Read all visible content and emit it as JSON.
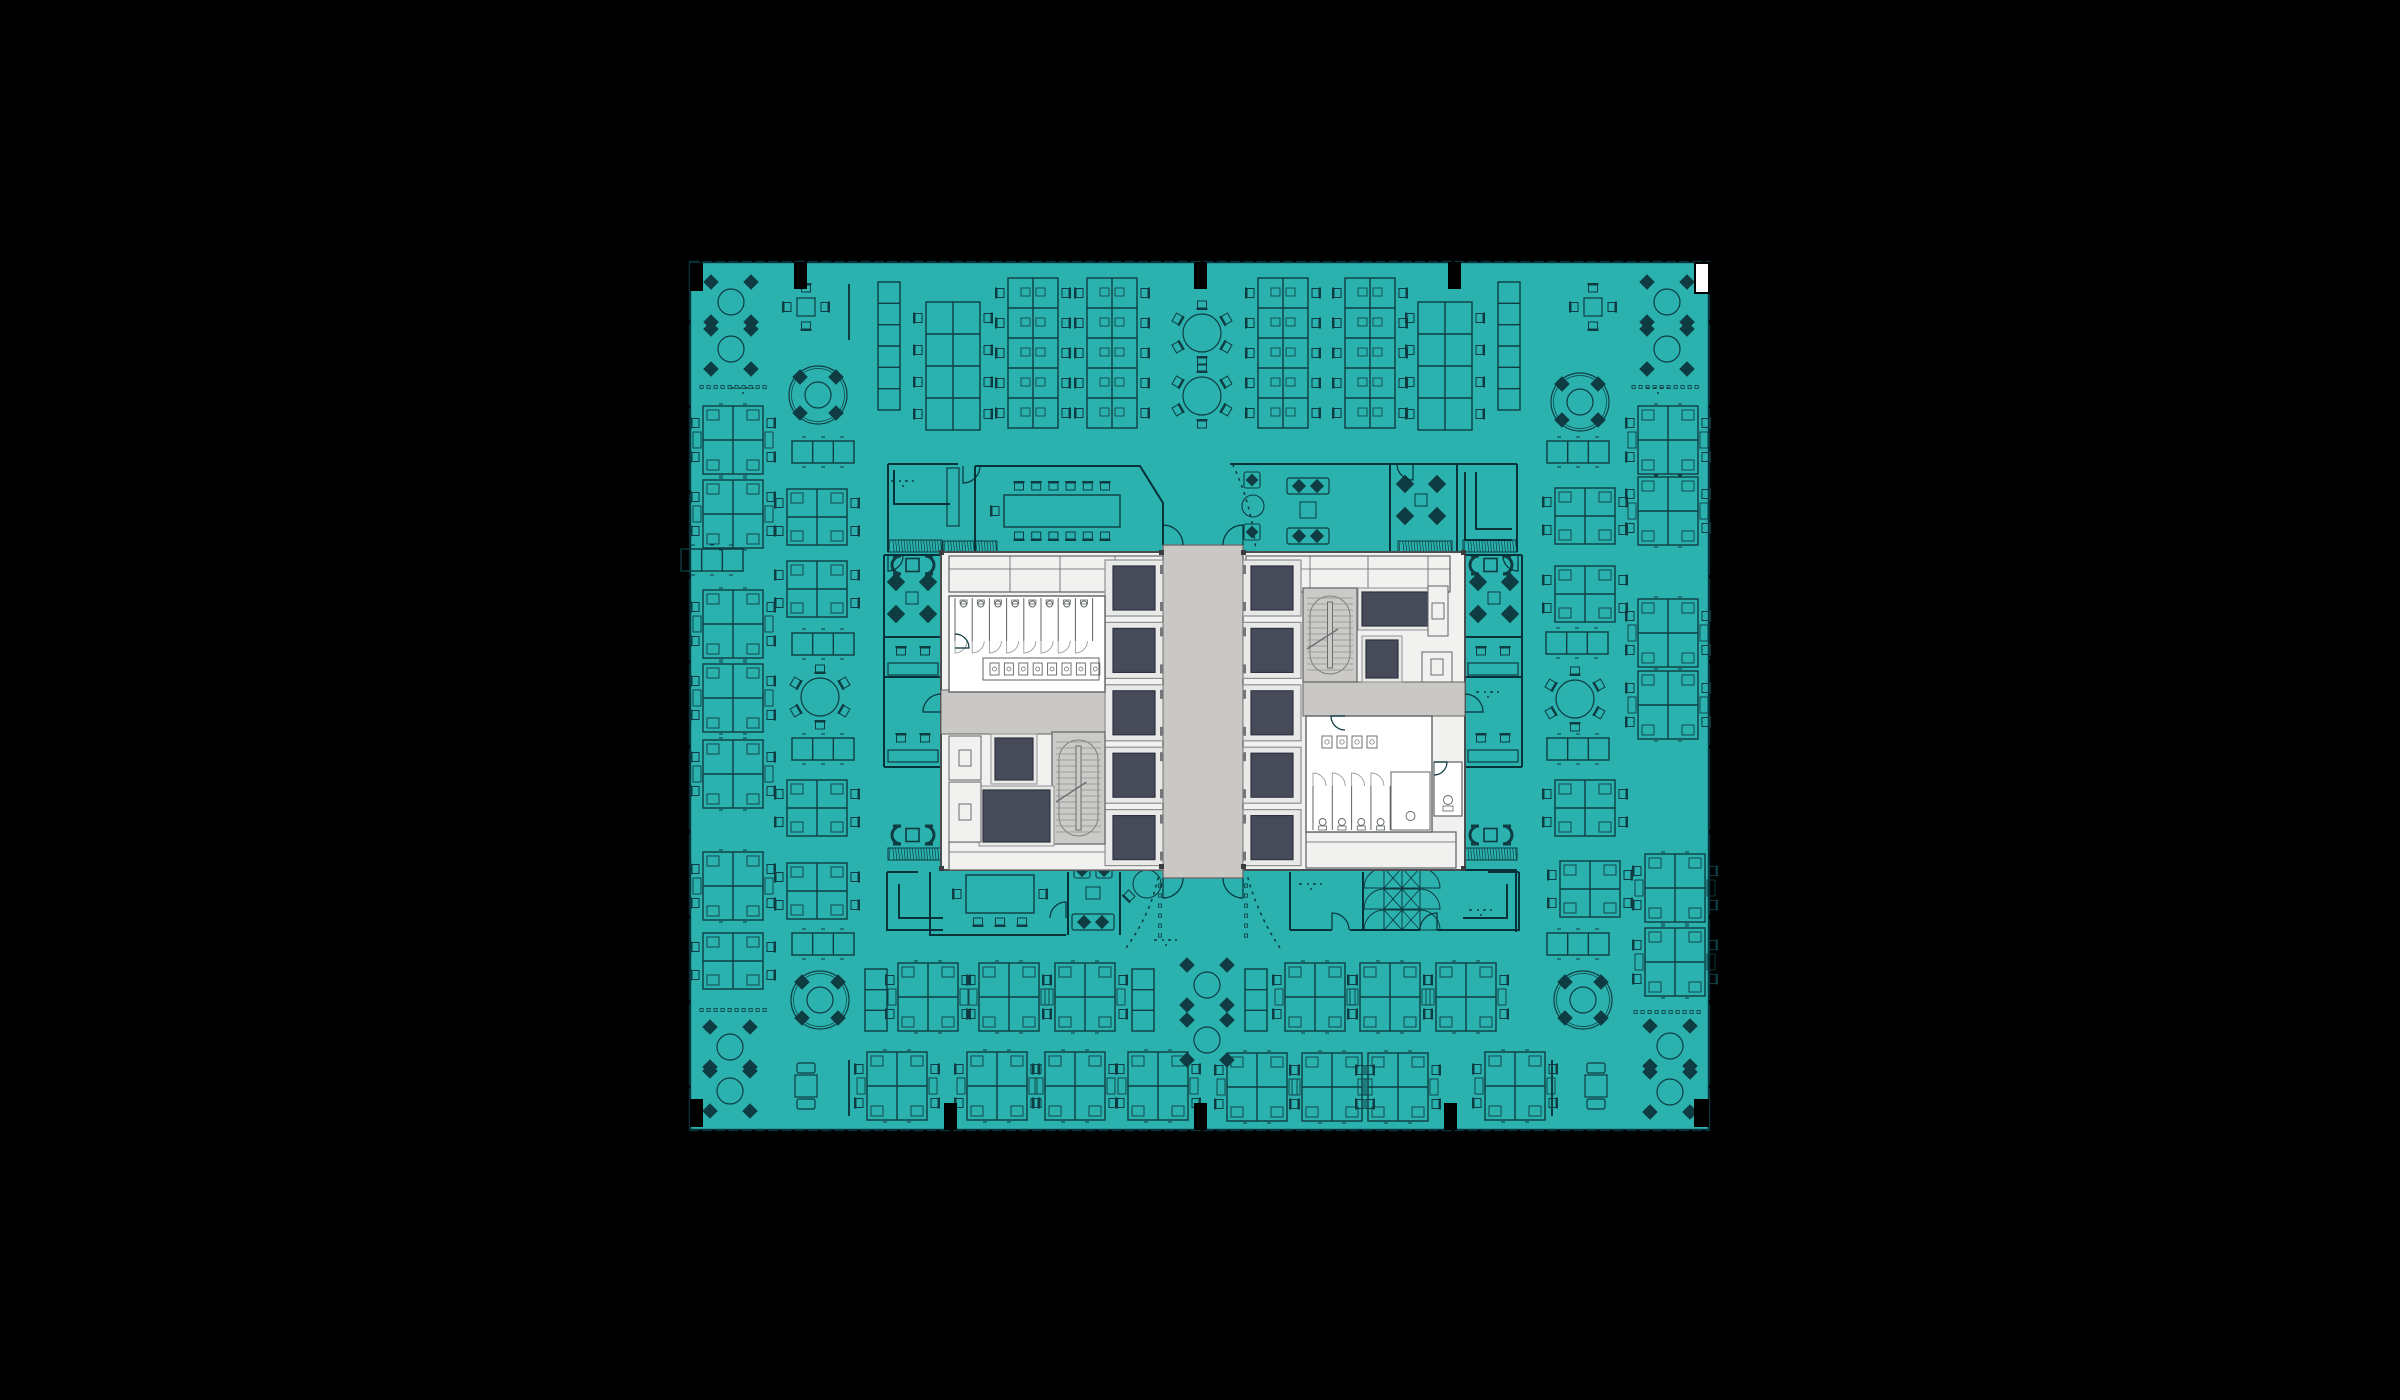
{
  "scene": {
    "width": 2400,
    "height": 1400,
    "background": "#000000",
    "description": "office-floor-plan"
  },
  "palette": {
    "teal": "#2BB2AE",
    "furnitureLine": "#0E3C42",
    "wallLine": "#06333A",
    "coreWhite": "#F1F1EF",
    "coreFill": "#EDEDEB",
    "coreWall": "#5E6264",
    "lobbyGray": "#C9C8C4",
    "stairGray": "#CBCAC7",
    "navy": "#464A59",
    "navyStroke": "#2E3240",
    "frame": "#E9E9E7",
    "frameStroke": "#8E9192",
    "black": "#000000",
    "white": "#FFFFFF",
    "darkSquare": "#3A3D3F",
    "notch": "#747678"
  },
  "plan": {
    "x": 690,
    "y": 262,
    "w": 1019,
    "h": 868,
    "tickStepTop": 13.2,
    "tickStepSide": 85
  },
  "columns": {
    "cornersBlack": [
      [
        690,
        263,
        13,
        28
      ],
      [
        690,
        1099,
        13,
        28
      ],
      [
        1694,
        1099,
        15,
        28
      ]
    ],
    "cornerWhite": [
      1695,
      263,
      14,
      30
    ],
    "topStubs": [
      794,
      1194,
      1448
    ],
    "bottomStubs": [
      944,
      1194,
      1444
    ],
    "stubSize": [
      13,
      27
    ]
  },
  "core": {
    "outer": [
      941,
      552,
      524,
      318
    ],
    "lobby": [
      1163,
      545,
      80,
      333
    ],
    "elevatorCols": [
      {
        "x": 1105,
        "w": 58,
        "y0": 560,
        "cellH": 56,
        "gap": 6.4,
        "count": 5,
        "doorSide": "right"
      },
      {
        "x": 1243,
        "w": 58,
        "y0": 560,
        "cellH": 56,
        "gap": 6.4,
        "count": 5,
        "doorSide": "left"
      }
    ],
    "topBands": [
      [
        949,
        556,
        214,
        36
      ],
      [
        1246,
        556,
        204,
        36
      ]
    ],
    "topBandDividersL": [
      1010,
      1060,
      1115
    ],
    "topBandDividersR": [
      1310,
      1368,
      1428
    ],
    "bottomBands": [
      [
        949,
        842,
        214,
        28
      ],
      [
        1306,
        832,
        150,
        36
      ]
    ],
    "vestibules": [
      [
        941,
        690,
        164,
        44
      ],
      [
        1303,
        682,
        162,
        34
      ]
    ],
    "stairs": [
      [
        1052,
        732,
        53,
        112
      ],
      [
        1303,
        588,
        54,
        94
      ]
    ],
    "navyRooms": [
      [
        995,
        738,
        38,
        42
      ],
      [
        983,
        790,
        67,
        52
      ],
      [
        1362,
        592,
        66,
        34
      ],
      [
        1366,
        640,
        32,
        38
      ]
    ],
    "closets": [
      [
        949,
        736,
        32,
        44
      ],
      [
        949,
        782,
        32,
        60
      ],
      [
        1428,
        586,
        20,
        50
      ],
      [
        1422,
        652,
        30,
        30
      ]
    ],
    "mensRR": {
      "room": [
        949,
        596,
        156,
        96
      ],
      "stalls": 8,
      "stallX0": 955,
      "stallStep": 17.2,
      "stallTop": 598,
      "stallBot": 641,
      "urinalY": 603,
      "sinkBand": [
        983,
        658,
        116,
        22
      ],
      "sinks": 8
    },
    "womensRR": {
      "room": [
        1306,
        716,
        126,
        116
      ],
      "sinks": 4,
      "sinkX0": 1322,
      "sinkStep": 15,
      "sinkY": 736,
      "stalls": 4,
      "stallX0": 1313,
      "stallStep": 19.3,
      "stallTop": 786,
      "stallBot": 830,
      "accessible": [
        1391,
        772,
        39,
        58
      ]
    },
    "wc": [
      1434,
      762,
      28,
      54
    ],
    "darkSquares": [
      [
        939,
        550
      ],
      [
        1461,
        550
      ],
      [
        939,
        866
      ],
      [
        1461,
        866
      ],
      [
        1159,
        550
      ],
      [
        1241,
        550
      ],
      [
        1159,
        864
      ],
      [
        1241,
        864
      ]
    ]
  },
  "walls": [
    "M888,464 H958",
    "M888,464 V552",
    "M894,470 V504 H950",
    "M975,466 V552",
    "M975,466 H1140 L1163,503 V545",
    "M1230,464 H1517",
    "M1517,464 V552",
    "M1390,464 V552",
    "M1457,464 V552",
    "M1465,472 V540 H1512",
    "M1476,472 V529 H1512",
    "M884,555 V767",
    "M884,555 H941",
    "M884,637 H941",
    "M884,677 H941",
    "M884,767 H941",
    "M887,872 V930 H943",
    "M887,872 H918",
    "M899,884 V918 H943",
    "M1522,555 V767",
    "M1465,555 H1522",
    "M1465,637 H1522",
    "M1465,677 H1522",
    "M1465,767 H1522",
    "M1519,872 V930 H1463",
    "M1519,872 H1488",
    "M1507,884 V918 H1463",
    "M930,872 V935 H1066",
    "M1068,872 V935",
    "M1120,872 V935",
    "M1290,872 V930",
    "M1290,930 H1332",
    "M1350,930 H1420",
    "M1437,930 H1465",
    "M1363,872 V930",
    "M1440,870 H1516 V932",
    "M1465,858 V870"
  ],
  "doorArcs": [
    "M963,466 L963,483 A17,17 0 0 0 980,466",
    "M1413,464 L1413,480 A16,16 0 0 1 1397,464",
    "M1066,918 L1066,902 A16,16 0 0 0 1050,918",
    "M1332,930 L1332,913 A17,17 0 0 1 1349,930",
    "M1437,930 L1437,913 A17,17 0 0 0 1420,930",
    "M888,556 L888,571 A15,15 0 0 0 903,556",
    "M1518,556 L1518,571 A15,15 0 0 1 1503,556",
    "M1163,545 V525 A20,20 0 0 1 1183,545",
    "M1243,545 V525 A20,20 0 0 0 1223,545",
    "M1163,878 V898 A20,20 0 0 0 1183,878",
    "M1243,878 V898 A20,20 0 0 1 1223,878",
    "M941,712 L923,712 A18,18 0 0 1 941,694",
    "M955,648 L969,648 A14,14 0 0 0 955,634",
    "M1465,712 L1483,712 A18,18 0 0 0 1465,694",
    "M1345,716 L1331,716 A14,14 0 0 0 1345,730",
    "M1434,762 L1447,762 A13,13 0 0 1 1434,775"
  ],
  "dottedPaths": [
    "M1233,465 Q1252,505 1256,552",
    "M1158,878 Q1150,915 1126,948",
    "M1248,878 Q1258,915 1280,948"
  ],
  "dotCols": [
    [
      1160,
      884,
      6
    ],
    [
      1246,
      884,
      6
    ]
  ],
  "furniture": [
    [
      "round4",
      731,
      302
    ],
    [
      "round4",
      731,
      349
    ],
    [
      "dotrow",
      733,
      387
    ],
    [
      "sq4",
      806,
      307
    ],
    [
      "vline",
      849,
      312
    ],
    [
      "lockers6v",
      889,
      346
    ],
    [
      "bench8",
      953,
      366
    ],
    [
      "bench10",
      1033,
      353
    ],
    [
      "bench10",
      1112,
      353
    ],
    [
      "round6",
      1202,
      333
    ],
    [
      "round6",
      1202,
      396
    ],
    [
      "bench10",
      1283,
      353
    ],
    [
      "bench10",
      1370,
      353
    ],
    [
      "bench8",
      1445,
      366
    ],
    [
      "lockers6v",
      1509,
      346
    ],
    [
      "sq4",
      1593,
      307
    ],
    [
      "round4",
      1667,
      302
    ],
    [
      "round4",
      1667,
      349
    ],
    [
      "dotrow",
      1665,
      387
    ],
    [
      "cluster6",
      733,
      440
    ],
    [
      "cluster6",
      733,
      514
    ],
    [
      "cluster6",
      733,
      624
    ],
    [
      "cluster6",
      733,
      698
    ],
    [
      "cluster6",
      733,
      774
    ],
    [
      "cluster6",
      733,
      886
    ],
    [
      "cluster4",
      733,
      961
    ],
    [
      "round4",
      730,
      1047
    ],
    [
      "round4",
      730,
      1091
    ],
    [
      "round4ring",
      818,
      395
    ],
    [
      "table3h",
      823,
      452
    ],
    [
      "cluster4",
      817,
      517
    ],
    [
      "cluster4",
      817,
      589
    ],
    [
      "table3h",
      823,
      644
    ],
    [
      "round6",
      820,
      697
    ],
    [
      "table3h",
      823,
      749
    ],
    [
      "cluster4",
      817,
      808
    ],
    [
      "cluster4",
      817,
      891
    ],
    [
      "table3h",
      823,
      944
    ],
    [
      "round4ring",
      820,
      1000
    ],
    [
      "sqtable2",
      806,
      1086
    ],
    [
      "vline",
      849,
      1088
    ],
    [
      "table3h",
      712,
      560
    ],
    [
      "lockers3v",
      876,
      1000
    ],
    [
      "cluster6",
      928,
      997
    ],
    [
      "cluster6",
      1009,
      997
    ],
    [
      "cluster6",
      1085,
      997
    ],
    [
      "lockers3v",
      1143,
      1000
    ],
    [
      "round4",
      1207,
      985
    ],
    [
      "round4",
      1207,
      1040
    ],
    [
      "lockers3v",
      1256,
      1000
    ],
    [
      "cluster6",
      1315,
      997
    ],
    [
      "cluster6",
      1390,
      997
    ],
    [
      "cluster6",
      1466,
      997
    ],
    [
      "cluster6",
      897,
      1086
    ],
    [
      "cluster6",
      997,
      1086
    ],
    [
      "cluster6",
      1075,
      1086
    ],
    [
      "cluster6",
      1158,
      1086
    ],
    [
      "cluster6",
      1257,
      1087
    ],
    [
      "cluster6",
      1332,
      1087
    ],
    [
      "cluster6",
      1398,
      1087
    ],
    [
      "cluster6",
      1515,
      1086
    ],
    [
      "sqtable2",
      1596,
      1086
    ],
    [
      "vline",
      1552,
      1088
    ],
    [
      "round4",
      1670,
      1046
    ],
    [
      "round4",
      1670,
      1092
    ],
    [
      "dotrow",
      733,
      1010
    ],
    [
      "dotrow",
      1667,
      1012
    ],
    [
      "round4ring",
      1580,
      402
    ],
    [
      "table3h",
      1578,
      452
    ],
    [
      "cluster4",
      1585,
      516
    ],
    [
      "cluster4",
      1585,
      594
    ],
    [
      "table3h",
      1577,
      643
    ],
    [
      "round6",
      1575,
      699
    ],
    [
      "table3h",
      1578,
      749
    ],
    [
      "cluster4",
      1585,
      808
    ],
    [
      "cluster4",
      1590,
      889
    ],
    [
      "table3h",
      1578,
      944
    ],
    [
      "round4ring",
      1583,
      1000
    ],
    [
      "cluster6",
      1668,
      440
    ],
    [
      "cluster6",
      1668,
      511
    ],
    [
      "cluster6",
      1668,
      633
    ],
    [
      "cluster6",
      1668,
      705
    ],
    [
      "cluster6",
      1675,
      888
    ],
    [
      "cluster6",
      1675,
      962
    ],
    [
      "conf14",
      1062,
      511
    ],
    [
      "armchair",
      1252,
      480
    ],
    [
      "circ12",
      1253,
      506
    ],
    [
      "armchair",
      1252,
      532
    ],
    [
      "sofa2",
      1308,
      486
    ],
    [
      "sqtable2s",
      1308,
      510
    ],
    [
      "sofa2",
      1308,
      536
    ],
    [
      "diag4",
      1421,
      500
    ],
    [
      "diag4",
      912,
      598
    ],
    [
      "diag4",
      1494,
      598
    ],
    [
      "benchroom",
      913,
      660
    ],
    [
      "benchroom",
      913,
      747
    ],
    [
      "benchroom",
      1493,
      660
    ],
    [
      "benchroom",
      1493,
      747
    ],
    [
      "printCD",
      913,
      565
    ],
    [
      "printCD",
      1491,
      565
    ],
    [
      "printCD",
      913,
      835
    ],
    [
      "printCD",
      1491,
      835
    ],
    [
      "hatch",
      915,
      546
    ],
    [
      "hatch",
      1490,
      546
    ],
    [
      "hatch",
      915,
      854
    ],
    [
      "hatch",
      1490,
      854
    ],
    [
      "hatch",
      970,
      547
    ],
    [
      "hatch",
      1425,
      547
    ],
    [
      "cab",
      953,
      497
    ],
    [
      "conf8",
      1000,
      894
    ],
    [
      "loungeBL",
      1093,
      896
    ],
    [
      "roundtable1",
      1147,
      884
    ],
    [
      "fanpart",
      1392,
      899
    ],
    [
      "dims",
      1168,
      940
    ],
    [
      "dims",
      745,
      388
    ],
    [
      "dims",
      905,
      481
    ],
    [
      "dims",
      1313,
      884
    ],
    [
      "dims",
      1483,
      910
    ],
    [
      "dims",
      1490,
      692
    ],
    [
      "dims",
      1660,
      388
    ]
  ],
  "counts": {
    "elevatorCells": 10,
    "mensStalls": 8,
    "womensStalls": 4,
    "benchRows": 6,
    "clusterSeats": 6
  }
}
